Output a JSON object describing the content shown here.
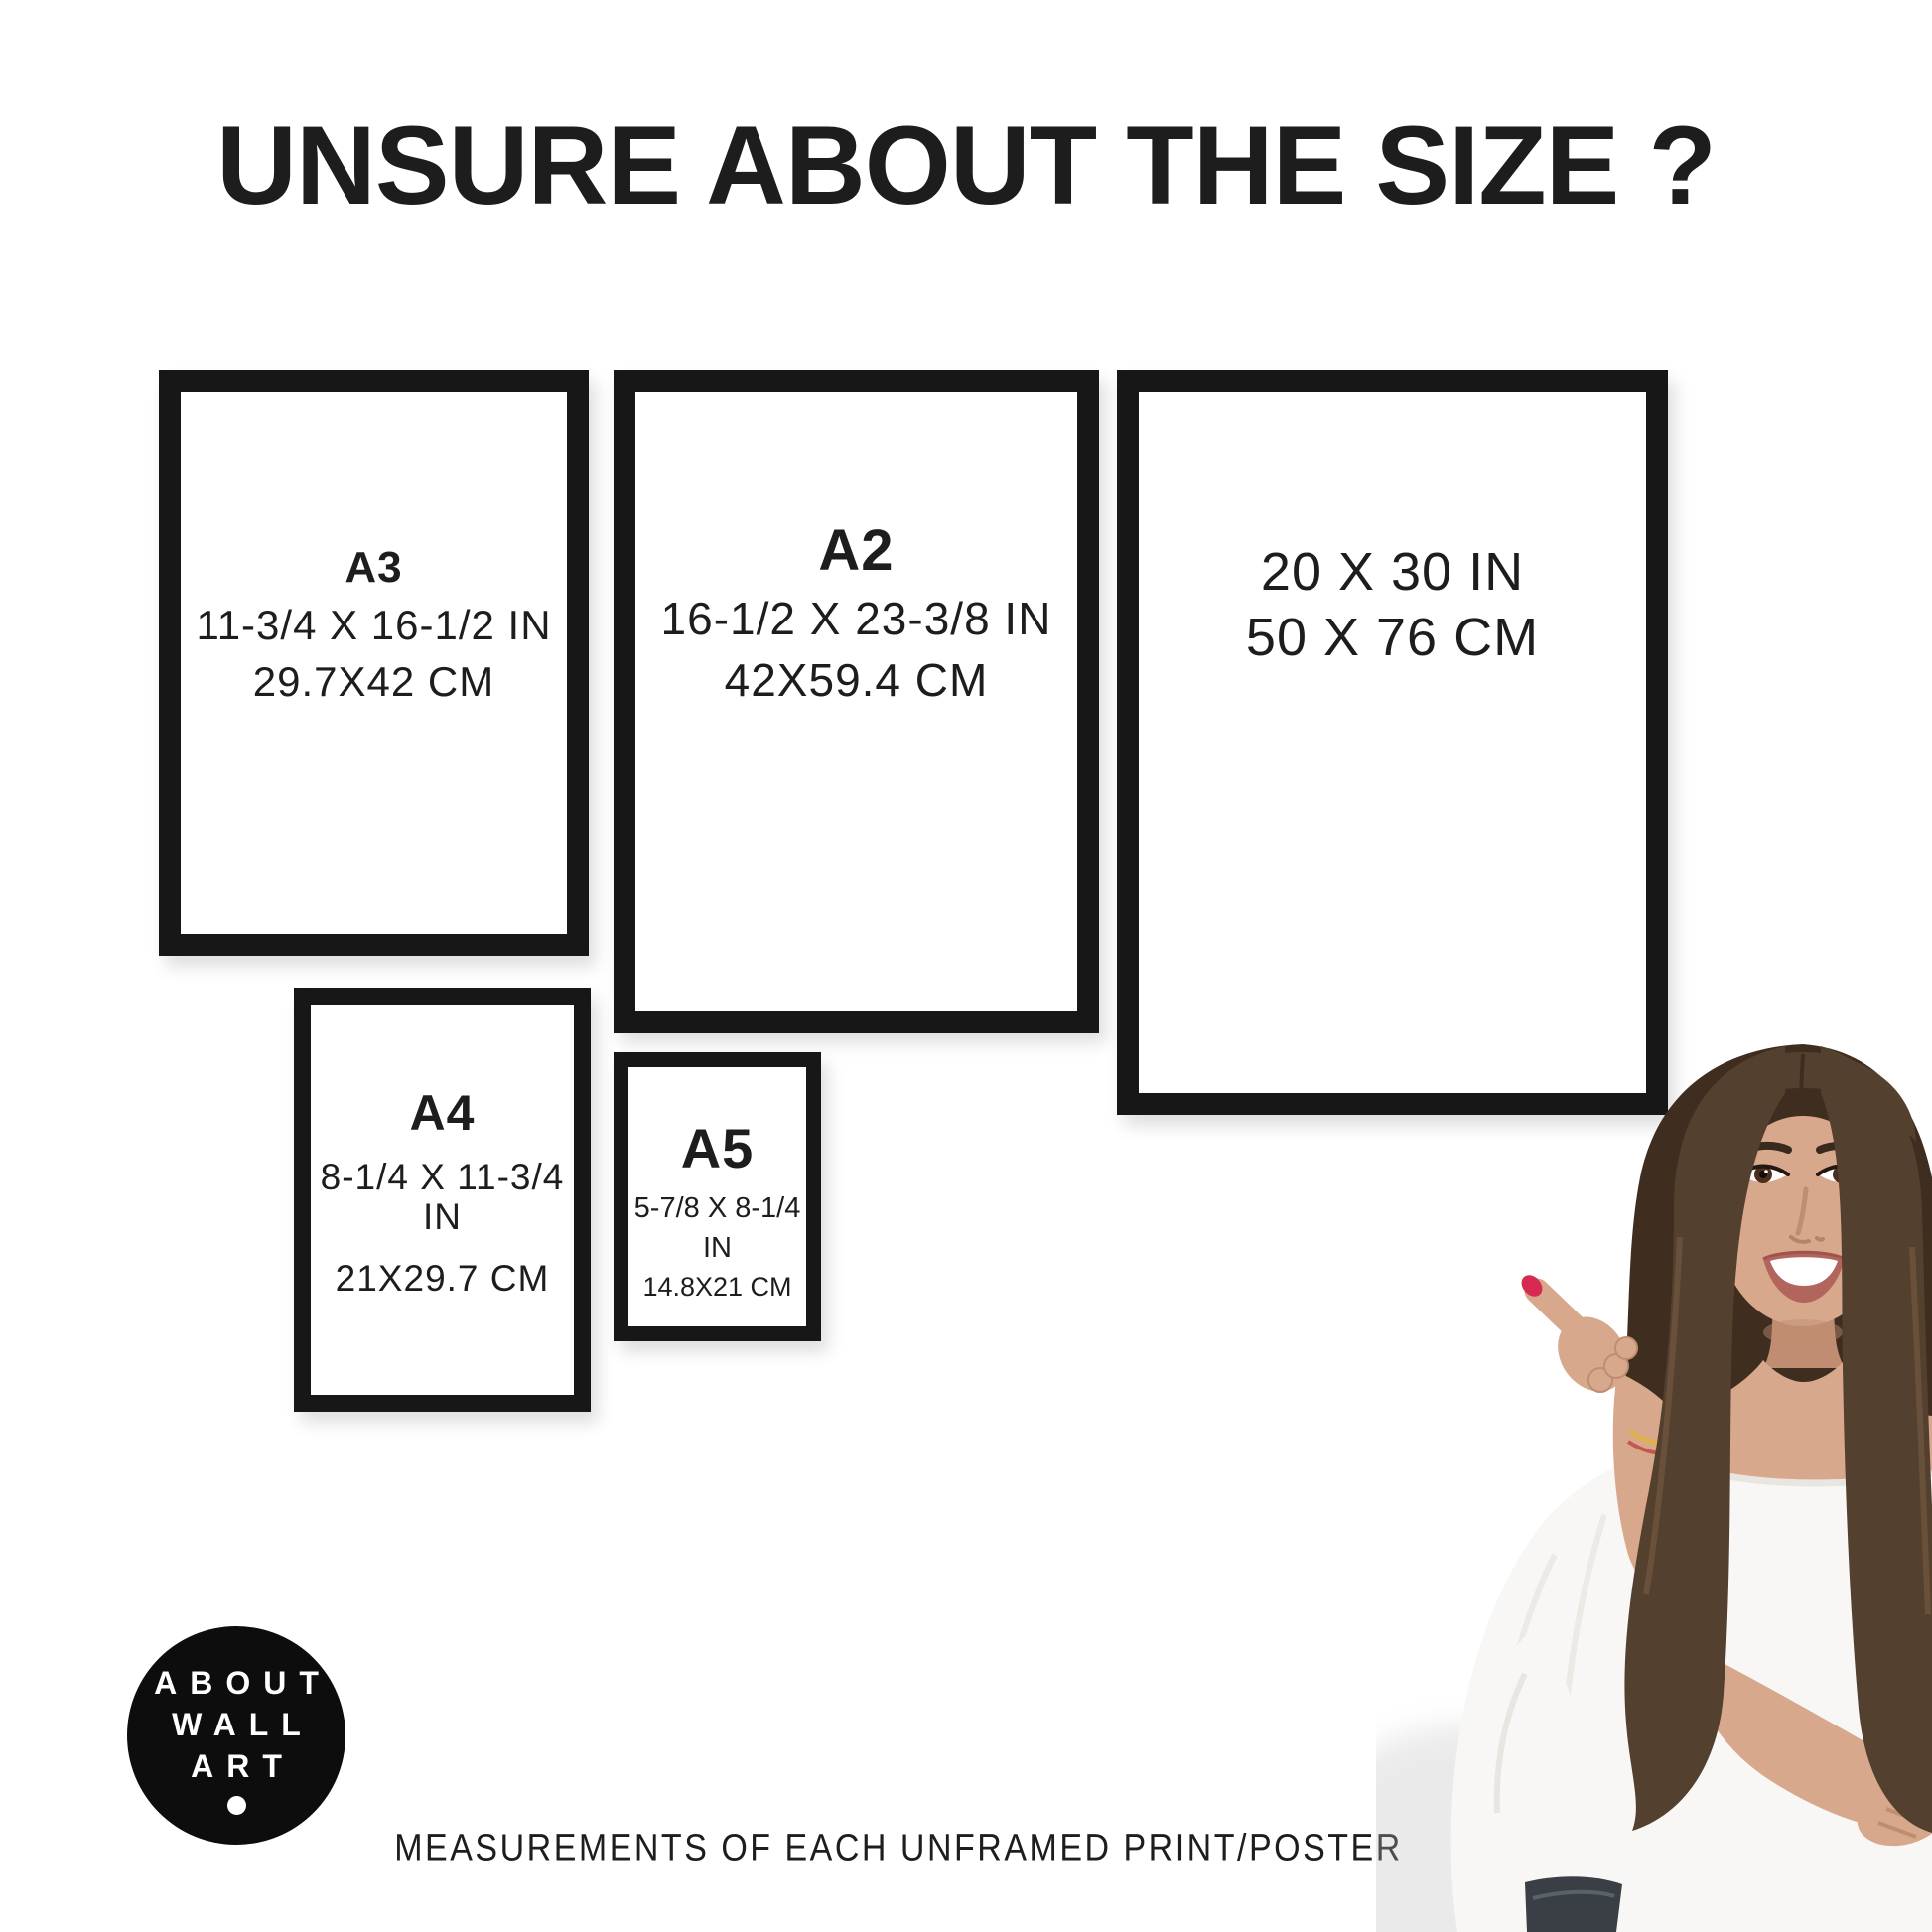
{
  "title": "UNSURE ABOUT THE SIZE ?",
  "footer_caption": "MEASUREMENTS OF EACH UNFRAMED PRINT/POSTER",
  "frames": {
    "a3": {
      "label": "A3",
      "inches": "11-3/4 X 16-1/2 IN",
      "cm": "29.7X42 CM"
    },
    "a2": {
      "label": "A2",
      "inches": "16-1/2 X 23-3/8 IN",
      "cm": "42X59.4 CM"
    },
    "poster_20x30": {
      "inches": "20 X 30 IN",
      "cm": "50 X 76 CM"
    },
    "a4": {
      "label": "A4",
      "inches": "8-1/4 X 11-3/4 IN",
      "cm": "21X29.7 CM"
    },
    "a5": {
      "label": "A5",
      "inches": "5-7/8 X 8-1/4 IN",
      "cm": "14.8X21 CM"
    }
  },
  "logo": {
    "line1": "ABOUT",
    "line2": "WALL",
    "line3": "ART"
  },
  "colors": {
    "background": "#ffffff",
    "text": "#1d1d1d",
    "frame_color": "#171717",
    "logo_bg": "#0d0d0d",
    "logo_text": "#ffffff",
    "hair": "#54402f",
    "hair_dark": "#3f2e20",
    "hair_light": "#7a5d45",
    "skin": "#d8a88c",
    "skin_shadow": "#c08d72",
    "blouse": "#f8f7f5",
    "blouse_shadow": "#e9e6e1",
    "lips": "#b2655c",
    "nail": "#d62a52",
    "jeans": "#3a3f46",
    "eye_brown": "#4a2f1d"
  }
}
